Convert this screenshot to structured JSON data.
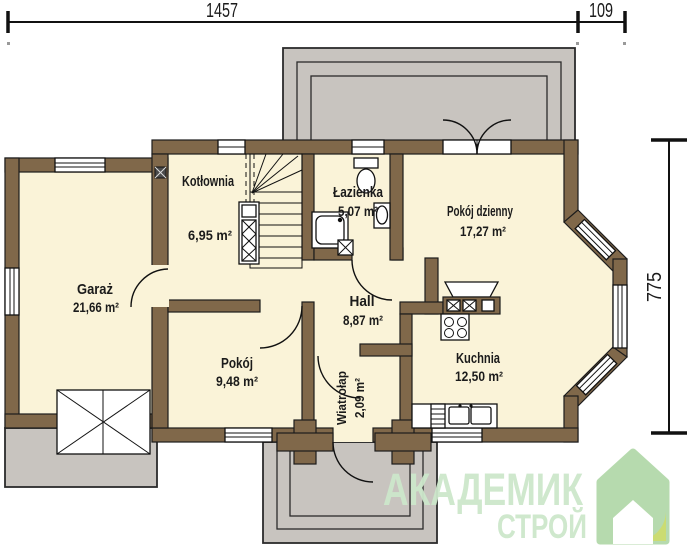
{
  "dimensions": {
    "top_width": "1457",
    "top_right_width": "109",
    "right_height": "775"
  },
  "rooms": {
    "kotlownia": {
      "name": "Kotłownia",
      "area": "6,95 m²"
    },
    "lazienka": {
      "name": "Łazienka",
      "area": "5,07 m²"
    },
    "pokoj_dzienny": {
      "name": "Pokój dzienny",
      "area": "17,27 m²"
    },
    "garaz": {
      "name": "Garaż",
      "area": "21,66 m²"
    },
    "hall": {
      "name": "Hall",
      "area": "8,87 m²"
    },
    "pokoj": {
      "name": "Pokój",
      "area": "9,48 m²"
    },
    "wiatrolap": {
      "name": "Wiatrołap",
      "area": "2,09 m²"
    },
    "kuchnia": {
      "name": "Kuchnia",
      "area": "12,50 m²"
    }
  },
  "watermark": {
    "line1": "АКАДЕМИК",
    "line2": "СТРОЙ"
  },
  "fixtures": [
    "staircase",
    "boiler",
    "shower",
    "toilet",
    "washbasin",
    "washing-machine",
    "vent-duct",
    "kitchen-hood",
    "cooktop",
    "kitchen-counter",
    "kitchen-sink",
    "dishwasher",
    "garage-door",
    "entrance-door",
    "french-door",
    "terrace",
    "entry-porch",
    "driveway"
  ],
  "colors": {
    "wall": "#80684a",
    "floor": "#faf3d8",
    "paving": "#c8c4bf",
    "line": "#1b1b1b",
    "watermark_text": "#cde7cb",
    "logo_green": "#b3d9aa",
    "logo_accent": "#c9db6b"
  }
}
